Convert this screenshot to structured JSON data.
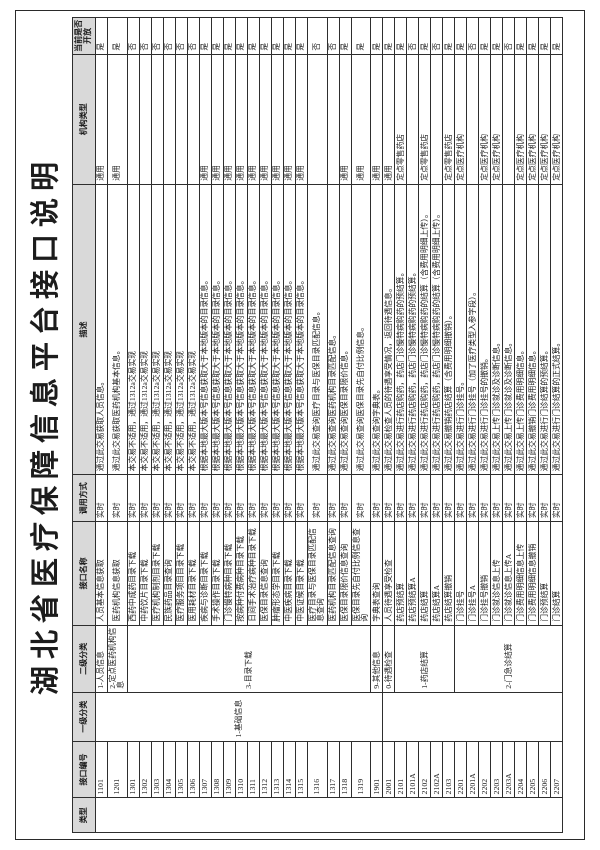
{
  "title": "湖北省医疗保障信息平台接口说明",
  "table": {
    "headers": [
      "类型",
      "接口编号",
      "一级分类",
      "二级分类",
      "接口名称",
      "调用方式",
      "描述",
      "机构类型",
      "当前是否开放"
    ],
    "type_column_value": "",
    "level1_groups": [
      {
        "label": "1-基础信息",
        "span": 22
      },
      {
        "label": "",
        "span": 15
      }
    ],
    "level2_groups": [
      {
        "label": "1-人员信息",
        "span": 1
      },
      {
        "label": "2-定点医药机构信息",
        "span": 1
      },
      {
        "label": "3-目录下载",
        "span": 19
      },
      {
        "label": "9-其他信息",
        "span": 1
      },
      {
        "label": "0-待遇检查",
        "span": 1
      },
      {
        "label": "1-药店结算",
        "span": 5
      },
      {
        "label": "2-门急诊结算",
        "span": 9
      }
    ],
    "rows": [
      {
        "id": "1101",
        "name": "人员基本信息获取",
        "mode": "实时",
        "desc": "通过此交易获取人员信息。",
        "org": "通用",
        "open": "是"
      },
      {
        "id": "1201",
        "name": "医药机构信息获取",
        "mode": "实时",
        "desc": "通过此交易获取医药机构基本信息。",
        "org": "通用",
        "open": "是"
      },
      {
        "id": "1301",
        "name": "西药中成药目录下载",
        "mode": "实时",
        "desc": "本交易不适用，通过1312a交易实现",
        "org": "",
        "open": "否"
      },
      {
        "id": "1302",
        "name": "中药饮片目录下载",
        "mode": "实时",
        "desc": "本交易不适用，通过1312a交易实现",
        "org": "",
        "open": "否"
      },
      {
        "id": "1303",
        "name": "医疗机构制剂目录下载",
        "mode": "实时",
        "desc": "本交易不适用，通过1312a交易实现",
        "org": "",
        "open": "否"
      },
      {
        "id": "1304",
        "name": "民族药品目录查询",
        "mode": "实时",
        "desc": "本交易不适用，通过1312a交易实现",
        "org": "",
        "open": "否"
      },
      {
        "id": "1305",
        "name": "医疗服务项目目录下载",
        "mode": "实时",
        "desc": "本交易不适用，通过1312a交易实现",
        "org": "",
        "open": "否"
      },
      {
        "id": "1306",
        "name": "医用耗材目录下载",
        "mode": "实时",
        "desc": "本交易不适用，通过1312a交易实现",
        "org": "",
        "open": "否"
      },
      {
        "id": "1307",
        "name": "疾病与诊断目录下载",
        "mode": "实时",
        "desc": "根据本地最大版本号信息获取大于本地版本的目录信息。",
        "org": "通用",
        "open": "是"
      },
      {
        "id": "1308",
        "name": "手术操作目录下载",
        "mode": "实时",
        "desc": "根据本地最大版本号信息获取大于本地版本的目录信息。",
        "org": "通用",
        "open": "是"
      },
      {
        "id": "1309",
        "name": "门诊慢特病种目录下载",
        "mode": "实时",
        "desc": "根据本地最大版本号信息获取大于本地版本的目录信息。",
        "org": "通用",
        "open": "是"
      },
      {
        "id": "1310",
        "name": "按病种付费病种目录下载",
        "mode": "实时",
        "desc": "根据本地最大版本号信息获取大于本地版本的目录信息。",
        "org": "通用",
        "open": "是"
      },
      {
        "id": "1311",
        "name": "日间手术治疗病种目录下载",
        "mode": "实时",
        "desc": "根据本地最大版本号信息获取大于本地版本的目录信息。",
        "org": "通用",
        "open": "是"
      },
      {
        "id": "1312",
        "name": "医保目录信息查询",
        "mode": "实时",
        "desc": "根据本地最大版本号信息获取大于本地版本的目录信息。",
        "org": "通用",
        "open": "是"
      },
      {
        "id": "1313",
        "name": "肿瘤形态学目录下载",
        "mode": "实时",
        "desc": "根据本地最大版本号信息获取大于本地版本的目录信息。",
        "org": "通用",
        "open": "是"
      },
      {
        "id": "1314",
        "name": "中医疾病目录下载",
        "mode": "实时",
        "desc": "根据本地最大版本号信息获取大于本地版本的目录信息。",
        "org": "通用",
        "open": "是"
      },
      {
        "id": "1315",
        "name": "中医证候目录下载",
        "mode": "实时",
        "desc": "根据本地最大版本号信息获取大于本地版本的目录信息。",
        "org": "通用",
        "open": "是"
      },
      {
        "id": "1316",
        "name": "医疗目录与医保目录匹配信息查询",
        "mode": "实时",
        "desc": "通过此交易查询医疗目录与医保目录匹配信息。",
        "org": "",
        "open": "否"
      },
      {
        "id": "1317",
        "name": "医药机构目录匹配信息查询",
        "mode": "实时",
        "desc": "通过此交易查询医药机构目录匹配信息。",
        "org": "",
        "open": "否"
      },
      {
        "id": "1318",
        "name": "医保目录限价信息查询",
        "mode": "实时",
        "desc": "通过此交易查询医保目录限价信息。",
        "org": "通用",
        "open": "是"
      },
      {
        "id": "1319",
        "name": "医保目录先自付比例信息查询",
        "mode": "实时",
        "desc": "通过此交易查询医保目录先自付比例信息。",
        "org": "通用",
        "open": "是"
      },
      {
        "id": "1901",
        "name": "字典表查询",
        "mode": "实时",
        "desc": "通过此交易查询字典表。",
        "org": "通用",
        "open": "是"
      },
      {
        "id": "2001",
        "name": "人员待遇享受检查",
        "mode": "实时",
        "desc": "通过此交易检查人员的待遇享受情况，返回待遇信息。",
        "org": "通用",
        "open": "是"
      },
      {
        "id": "2101",
        "name": "药店预结算",
        "mode": "实时",
        "desc": "通过此交易进行药店购药，药店门诊慢特病购药的预结算。",
        "org": "定点零售药店",
        "open": "是"
      },
      {
        "id": "2101A",
        "name": "药店预结算A",
        "mode": "实时",
        "desc": "通过此交易进行药店购药，药店门诊慢特病购药的预结算。",
        "org": "",
        "open": "否"
      },
      {
        "id": "2102",
        "name": "药店结算",
        "mode": "实时",
        "desc": "通过此交易进行药店购药，药店门诊慢特病购药的结算（含费用明细上传）。",
        "org": "定点零售药店",
        "open": "是"
      },
      {
        "id": "2102A",
        "name": "药店结算A",
        "mode": "实时",
        "desc": "通过此交易进行药店购药，药店门诊慢特病购药的结算（含费用明细上传）。",
        "org": "",
        "open": "否"
      },
      {
        "id": "2103",
        "name": "药店结算撤销",
        "mode": "实时",
        "desc": "通过此交易撤销药店结算（含费用明细撤销）。",
        "org": "定点零售药店",
        "open": "是"
      },
      {
        "id": "2201",
        "name": "门诊挂号",
        "mode": "实时",
        "desc": "通过此交易进行门诊挂号。",
        "org": "定点医疗机构",
        "open": "是"
      },
      {
        "id": "2201A",
        "name": "门诊挂号A",
        "mode": "实时",
        "desc": "通过此交易进行门诊挂号（加了医疗类型入参字段）。",
        "org": "",
        "open": "否"
      },
      {
        "id": "2202",
        "name": "门诊挂号撤销",
        "mode": "实时",
        "desc": "通过此交易进行门诊挂号的撤销。",
        "org": "定点医疗机构",
        "open": "是"
      },
      {
        "id": "2203",
        "name": "门诊就诊信息上传",
        "mode": "实时",
        "desc": "通过此交易上传门诊就诊及诊断信息。",
        "org": "定点医疗机构",
        "open": "是"
      },
      {
        "id": "2203A",
        "name": "门诊就诊信息上传A",
        "mode": "实时",
        "desc": "通过此交易上传门诊就诊及诊断信息。",
        "org": "",
        "open": "否"
      },
      {
        "id": "2204",
        "name": "门诊费用明细信息上传",
        "mode": "实时",
        "desc": "通过此交易上传门诊费用明细信息。",
        "org": "定点医疗机构",
        "open": "是"
      },
      {
        "id": "2205",
        "name": "门诊费用明细信息撤销",
        "mode": "实时",
        "desc": "通过此交易撤销门诊费用明细信息。",
        "org": "定点医疗机构",
        "open": "是"
      },
      {
        "id": "2206",
        "name": "门诊预结算",
        "mode": "实时",
        "desc": "通过此交易进行门诊结算的预结算。",
        "org": "定点医疗机构",
        "open": "是"
      },
      {
        "id": "2207",
        "name": "门诊结算",
        "mode": "实时",
        "desc": "通过此交易进行门诊结算的正式结算。",
        "org": "定点医疗机构",
        "open": "是"
      }
    ]
  }
}
